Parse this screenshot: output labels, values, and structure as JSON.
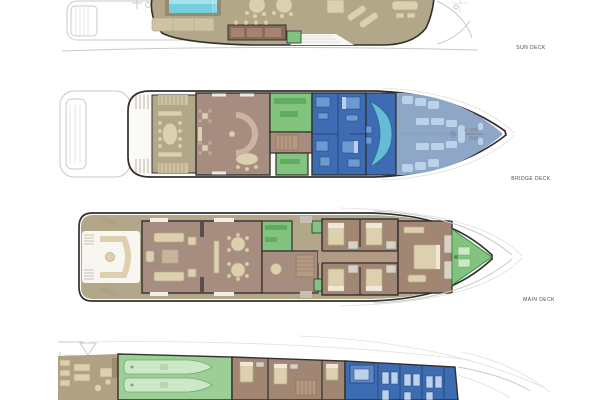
{
  "deck_labels": {
    "sun": "SUN DECK",
    "bridge": "BRIDGE DECK",
    "main": "MAIN DECK"
  },
  "palette": {
    "deck-tan": "#b3a78a",
    "deck-tan-light": "#cfc3a2",
    "fur-cream": "#dcd0ae",
    "mauve": "#a78d80",
    "cabin-brown": "#a18674",
    "green": "#82c47f",
    "green-dark": "#5fae5f",
    "green-light": "#cde8c6",
    "garage-green": "#9ccf96",
    "blue": "#3e6cb2",
    "blue-mid": "#6f9ad1",
    "blue-light": "#bcd2ea",
    "slate": "#8ea7c7",
    "cyan": "#64bcd9",
    "pool": "#74cedd",
    "pool-light": "#a5e2ec",
    "bar-brown": "#8a6a58",
    "wall": "#30302e",
    "ghost": "#c9c9c7",
    "label": "#4a4a4a",
    "bg": "#ffffff"
  }
}
